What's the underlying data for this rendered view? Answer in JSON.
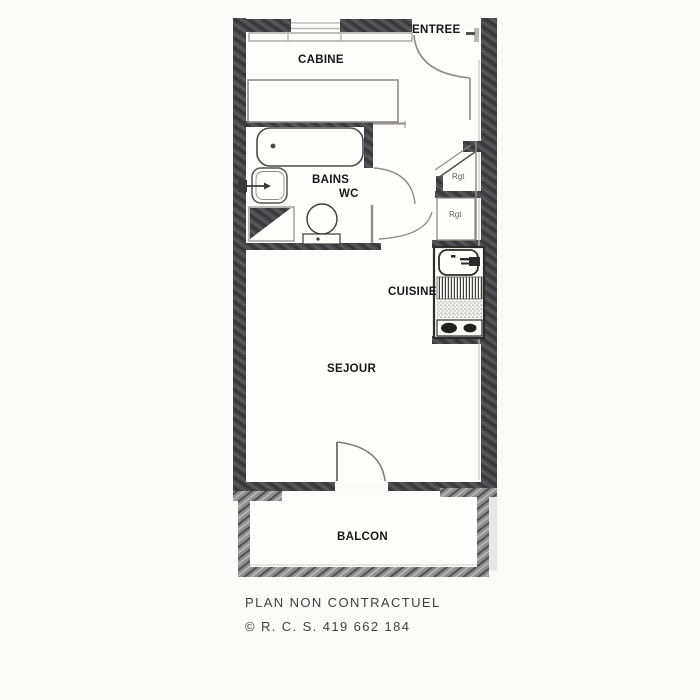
{
  "title": "Apartment floor plan",
  "labels": {
    "entree": "ENTREE",
    "cabine": "CABINE",
    "bains": "BAINS",
    "wc": "WC",
    "rgt_top": "Rgt",
    "rgt_bottom": "Rgt",
    "cuisine": "CUISINE",
    "sejour": "SEJOUR",
    "balcon": "BALCON"
  },
  "footer": {
    "line1": "PLAN NON CONTRACTUEL",
    "line2": "© R. C. S. 419 662 184"
  },
  "colors": {
    "bg": "#fcfbf8",
    "paper": "#fffefb",
    "wall": "#48484b",
    "rail": "#909092",
    "line": "#8f8c88",
    "fixture": "#3c3a38",
    "text": "#161616",
    "muted": "#5a5a5a",
    "footer": "#3f3f3f"
  }
}
